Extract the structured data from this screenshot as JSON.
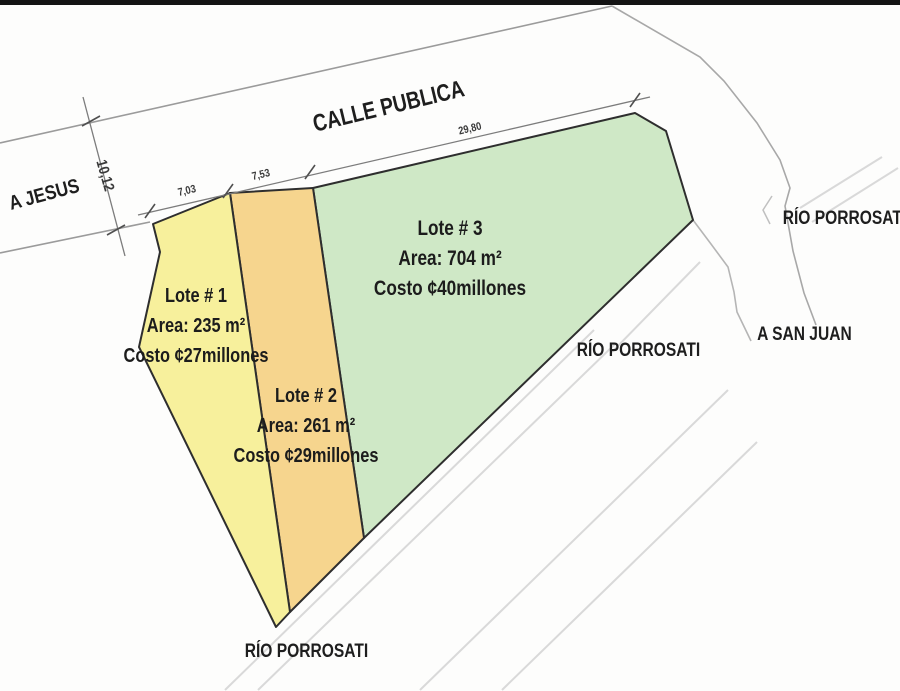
{
  "roads": {
    "calle_publica": "CALLE PUBLICA",
    "a_jesus": "A JESUS",
    "a_san_juan": "A SAN JUAN"
  },
  "river": {
    "label": "RÍO PORROSATI"
  },
  "dimensions": {
    "street_width": "10,12",
    "lot1_front": "7,03",
    "lot2_front": "7,53",
    "lot3_front": "29,80"
  },
  "lots": [
    {
      "name": "Lote # 1",
      "area": "Area: 235 m²",
      "cost": "Costo ¢27millones",
      "color": "#f7f09c"
    },
    {
      "name": "Lote # 2",
      "area": "Area: 261 m²",
      "cost": "Costo ¢29millones",
      "color": "#f6d58e"
    },
    {
      "name": "Lote # 3",
      "area": "Area: 704 m²",
      "cost": "Costo ¢40millones",
      "color": "#cfe8c6"
    }
  ],
  "colors": {
    "outline": "#2e2e2e",
    "road_line": "#9b9b9b",
    "river_line": "#b0b0b0",
    "hatch": "#d9d9d9",
    "top_bar": "#141414"
  }
}
